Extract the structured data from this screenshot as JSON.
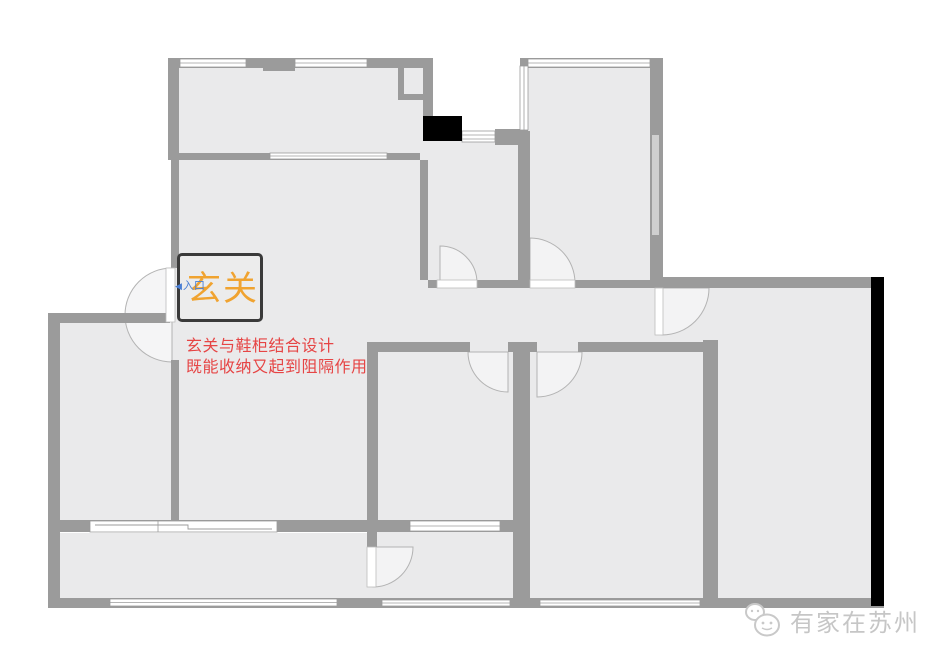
{
  "page": {
    "kind": "apartment-floor-plan-photo",
    "background": "#ffffff",
    "width": 939,
    "height": 664
  },
  "floor_plan": {
    "entry_box": {
      "label": "玄关",
      "text_color": "#F0A330",
      "border_color": "#3A3A3A",
      "fill_color": "#ECECEC"
    },
    "entrance_marker": {
      "label": "入口",
      "icon": "left-arrow-icon",
      "arrow_glyph": "◀",
      "color": "#4A7FD4"
    },
    "annotation": {
      "lines": [
        "玄关与鞋柜结合设计",
        "既能收纳又起到阻隔作用"
      ],
      "color": "#E64545"
    },
    "watermark": {
      "text": "有家在苏州",
      "icon": "chat-bubbles-logo-icon",
      "color": "#C6C6C6"
    },
    "colors": {
      "wall_gray": "#9B9B9B",
      "floor_gray": "#EAEAEB",
      "door_swing_fill": "#F3F3F4",
      "window_white": "#FFFFFF",
      "window_inset_gray": "#CFCFCF",
      "shaft_black": "#000000",
      "outer_wall_black": "#000000"
    }
  }
}
